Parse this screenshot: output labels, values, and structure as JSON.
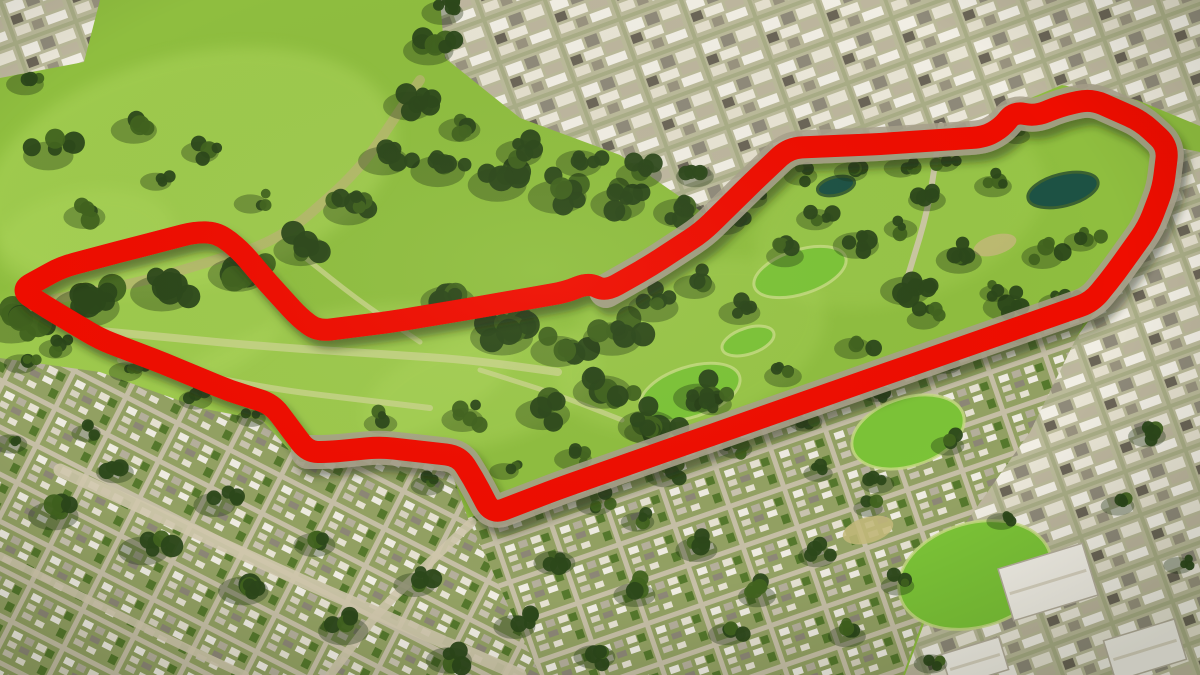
{
  "scene": {
    "title": "Aerial 3D satellite view of a large urban park with a red street-circuit outline",
    "canvas_width": 1200,
    "canvas_height": 675,
    "palette": {
      "grass": "#8fbe3f",
      "grass_light": "#aed75c",
      "grass_bright": "#7cc437",
      "tree": "#2c481a",
      "tree_light": "#41631f",
      "tree_shadow": "#1c3110",
      "path_pale": "#ccd490",
      "creek": "#b8b472",
      "road_light": "#cfc7ac",
      "road": "#a8a18b",
      "water": "#1d5244",
      "building_white": "#f2efe6",
      "building_edge": "#b5ae9c",
      "track_red": "#ef0702",
      "track_shadow": "#1f2a10"
    }
  },
  "track": {
    "name": "street-circuit-outline",
    "stroke_width": 22,
    "corner_radius": 13,
    "closed": true,
    "points": [
      [
        20,
        290
      ],
      [
        62,
        267
      ],
      [
        130,
        249
      ],
      [
        196,
        232
      ],
      [
        218,
        233
      ],
      [
        240,
        250
      ],
      [
        268,
        283
      ],
      [
        300,
        318
      ],
      [
        318,
        331
      ],
      [
        390,
        322
      ],
      [
        468,
        309
      ],
      [
        520,
        300
      ],
      [
        566,
        292
      ],
      [
        588,
        283
      ],
      [
        606,
        291
      ],
      [
        650,
        266
      ],
      [
        702,
        232
      ],
      [
        756,
        179
      ],
      [
        789,
        148
      ],
      [
        880,
        144
      ],
      [
        985,
        137
      ],
      [
        1002,
        127
      ],
      [
        1014,
        112
      ],
      [
        1036,
        116
      ],
      [
        1060,
        106
      ],
      [
        1091,
        99
      ],
      [
        1141,
        121
      ],
      [
        1168,
        146
      ],
      [
        1163,
        188
      ],
      [
        1148,
        227
      ],
      [
        1116,
        272
      ],
      [
        1092,
        302
      ],
      [
        900,
        369
      ],
      [
        700,
        439
      ],
      [
        560,
        488
      ],
      [
        492,
        514
      ],
      [
        473,
        478
      ],
      [
        459,
        456
      ],
      [
        380,
        447
      ],
      [
        330,
        452
      ],
      [
        308,
        452
      ],
      [
        292,
        431
      ],
      [
        272,
        404
      ],
      [
        230,
        391
      ],
      [
        165,
        364
      ],
      [
        100,
        339
      ],
      [
        48,
        308
      ]
    ]
  },
  "road_underlay": {
    "stroke_width": 34,
    "points": [
      [
        606,
        291
      ],
      [
        650,
        266
      ],
      [
        702,
        232
      ],
      [
        756,
        179
      ],
      [
        789,
        148
      ],
      [
        880,
        144
      ],
      [
        985,
        137
      ],
      [
        1002,
        127
      ],
      [
        1014,
        112
      ],
      [
        1036,
        116
      ],
      [
        1060,
        106
      ],
      [
        1091,
        99
      ],
      [
        1141,
        121
      ],
      [
        1168,
        146
      ],
      [
        1163,
        188
      ],
      [
        1148,
        227
      ],
      [
        1116,
        272
      ],
      [
        1092,
        302
      ],
      [
        900,
        369
      ],
      [
        700,
        439
      ],
      [
        560,
        488
      ],
      [
        492,
        514
      ],
      [
        473,
        478
      ],
      [
        459,
        456
      ],
      [
        380,
        447
      ],
      [
        330,
        452
      ],
      [
        308,
        452
      ]
    ]
  },
  "features": {
    "meadows": [
      {
        "x": 190,
        "y": 170,
        "rx": 210,
        "ry": 115,
        "rot": -14,
        "o": 0.5
      },
      {
        "x": 130,
        "y": 330,
        "rx": 160,
        "ry": 70,
        "rot": -10,
        "o": 0.5
      },
      {
        "x": 330,
        "y": 385,
        "rx": 185,
        "ry": 72,
        "rot": -12,
        "o": 0.45
      },
      {
        "x": 480,
        "y": 390,
        "rx": 120,
        "ry": 55,
        "rot": -15,
        "o": 0.4
      },
      {
        "x": 690,
        "y": 345,
        "rx": 140,
        "ry": 80,
        "rot": -18,
        "o": 0.3
      },
      {
        "x": 900,
        "y": 215,
        "rx": 150,
        "ry": 85,
        "rot": -18,
        "o": 0.28
      },
      {
        "x": 85,
        "y": 240,
        "rx": 90,
        "ry": 50,
        "rot": -10,
        "o": 0.4
      }
    ],
    "park_paths": [
      {
        "pts": [
          [
            90,
            330
          ],
          [
            260,
            346
          ],
          [
            470,
            360
          ],
          [
            558,
            372
          ]
        ],
        "w": 8
      },
      {
        "pts": [
          [
            120,
            360
          ],
          [
            280,
            390
          ],
          [
            430,
            408
          ]
        ],
        "w": 6
      },
      {
        "pts": [
          [
            298,
            252
          ],
          [
            358,
            300
          ],
          [
            420,
            342
          ]
        ],
        "w": 5
      },
      {
        "pts": [
          [
            480,
            370
          ],
          [
            556,
            394
          ],
          [
            622,
            420
          ]
        ],
        "w": 5
      },
      {
        "pts": [
          [
            0,
            310
          ],
          [
            150,
            280
          ],
          [
            280,
            240
          ],
          [
            360,
            170
          ],
          [
            420,
            80
          ]
        ],
        "w": 10,
        "c": "creek"
      }
    ],
    "city_regions": [
      {
        "pattern": "city",
        "points": [
          [
            440,
            0
          ],
          [
            1200,
            0
          ],
          [
            1200,
            126
          ],
          [
            1137,
            100
          ],
          [
            1062,
            85
          ],
          [
            1002,
            110
          ],
          [
            986,
            133
          ],
          [
            792,
            141
          ],
          [
            706,
            215
          ],
          [
            620,
            155
          ],
          [
            520,
            118
          ],
          [
            445,
            58
          ]
        ]
      },
      {
        "pattern": "city",
        "points": [
          [
            0,
            0
          ],
          [
            100,
            0
          ],
          [
            84,
            62
          ],
          [
            0,
            78
          ]
        ]
      },
      {
        "pattern": "city",
        "points": [
          [
            1180,
            148
          ],
          [
            1200,
            152
          ],
          [
            1200,
            675
          ],
          [
            905,
            675
          ],
          [
            955,
            540
          ],
          [
            1005,
            432
          ],
          [
            1060,
            360
          ],
          [
            1098,
            308
          ],
          [
            1135,
            242
          ],
          [
            1158,
            206
          ]
        ]
      },
      {
        "pattern": "resid1",
        "points": [
          [
            0,
            358
          ],
          [
            100,
            372
          ],
          [
            200,
            408
          ],
          [
            262,
            420
          ],
          [
            300,
            462
          ],
          [
            444,
            452
          ],
          [
            468,
            518
          ],
          [
            540,
            675
          ],
          [
            0,
            675
          ]
        ]
      },
      {
        "pattern": "resid2",
        "points": [
          [
            468,
            518
          ],
          [
            1092,
            306
          ],
          [
            1030,
            432
          ],
          [
            950,
            545
          ],
          [
            903,
            675
          ],
          [
            540,
            675
          ]
        ]
      }
    ],
    "sports_fields": [
      {
        "x": 800,
        "y": 272,
        "rx": 48,
        "ry": 22,
        "rot": -18
      },
      {
        "x": 690,
        "y": 392,
        "rx": 52,
        "ry": 25,
        "rot": -18
      },
      {
        "x": 908,
        "y": 432,
        "rx": 58,
        "ry": 34,
        "rot": -18
      },
      {
        "x": 748,
        "y": 341,
        "rx": 27,
        "ry": 13,
        "rot": -18
      },
      {
        "x": 975,
        "y": 575,
        "rx": 78,
        "ry": 52,
        "rot": -16
      }
    ],
    "dirt_patches": [
      {
        "x": 868,
        "y": 530,
        "rx": 26,
        "ry": 13,
        "rot": -16
      },
      {
        "x": 995,
        "y": 245,
        "rx": 22,
        "ry": 10,
        "rot": -16
      }
    ],
    "ponds": [
      {
        "x": 1063,
        "y": 190,
        "rx": 36,
        "ry": 16,
        "rot": -14
      },
      {
        "x": 836,
        "y": 186,
        "rx": 19,
        "ry": 9,
        "rot": -14
      }
    ],
    "roads": [
      {
        "pts": [
          [
            941,
            125
          ],
          [
            928,
            210
          ],
          [
            903,
            292
          ]
        ],
        "w": 6
      },
      {
        "pts": [
          [
            60,
            470
          ],
          [
            300,
            580
          ],
          [
            520,
            675
          ]
        ],
        "w": 13
      },
      {
        "pts": [
          [
            0,
            556
          ],
          [
            180,
            645
          ],
          [
            245,
            675
          ]
        ],
        "w": 8
      },
      {
        "pts": [
          [
            472,
            522
          ],
          [
            430,
            562
          ],
          [
            378,
            612
          ],
          [
            330,
            675
          ]
        ],
        "w": 9
      }
    ],
    "big_buildings": [
      {
        "x": 1048,
        "y": 582,
        "w": 88,
        "h": 54,
        "rot": -17
      },
      {
        "x": 1145,
        "y": 650,
        "w": 74,
        "h": 42,
        "rot": -17
      },
      {
        "x": 975,
        "y": 662,
        "w": 60,
        "h": 34,
        "rot": -17
      }
    ],
    "tree_clusters": [
      [
        20,
        318,
        30,
        8
      ],
      [
        95,
        300,
        32,
        9
      ],
      [
        170,
        286,
        30,
        8
      ],
      [
        245,
        268,
        28,
        8
      ],
      [
        308,
        244,
        26,
        7
      ],
      [
        355,
        205,
        24,
        7
      ],
      [
        390,
        155,
        24,
        7
      ],
      [
        415,
        100,
        24,
        7
      ],
      [
        435,
        45,
        24,
        7
      ],
      [
        448,
        8,
        20,
        5
      ],
      [
        55,
        150,
        24,
        5
      ],
      [
        140,
        125,
        22,
        4
      ],
      [
        90,
        212,
        20,
        4
      ],
      [
        205,
        148,
        18,
        4
      ],
      [
        30,
        80,
        18,
        4
      ],
      [
        255,
        200,
        16,
        3
      ],
      [
        160,
        178,
        15,
        3
      ],
      [
        445,
        165,
        26,
        7
      ],
      [
        505,
        178,
        28,
        8
      ],
      [
        565,
        190,
        28,
        8
      ],
      [
        625,
        198,
        26,
        7
      ],
      [
        685,
        207,
        24,
        6
      ],
      [
        730,
        218,
        20,
        5
      ],
      [
        465,
        125,
        20,
        5
      ],
      [
        525,
        148,
        22,
        5
      ],
      [
        585,
        158,
        22,
        5
      ],
      [
        645,
        170,
        22,
        5
      ],
      [
        700,
        172,
        18,
        4
      ],
      [
        755,
        195,
        16,
        4
      ],
      [
        455,
        295,
        26,
        7
      ],
      [
        510,
        330,
        30,
        8
      ],
      [
        565,
        345,
        26,
        7
      ],
      [
        620,
        332,
        28,
        7
      ],
      [
        660,
        302,
        24,
        6
      ],
      [
        610,
        385,
        28,
        7
      ],
      [
        550,
        408,
        26,
        6
      ],
      [
        655,
        420,
        28,
        7
      ],
      [
        705,
        392,
        24,
        6
      ],
      [
        745,
        308,
        20,
        5
      ],
      [
        700,
        282,
        20,
        5
      ],
      [
        790,
        252,
        18,
        4
      ],
      [
        820,
        215,
        18,
        4
      ],
      [
        805,
        172,
        16,
        4
      ],
      [
        855,
        168,
        16,
        4
      ],
      [
        905,
        164,
        16,
        4
      ],
      [
        948,
        160,
        14,
        3
      ],
      [
        1020,
        133,
        13,
        3
      ],
      [
        862,
        240,
        22,
        5
      ],
      [
        912,
        285,
        24,
        6
      ],
      [
        965,
        255,
        22,
        5
      ],
      [
        1012,
        302,
        22,
        5
      ],
      [
        1048,
        252,
        20,
        4
      ],
      [
        998,
        182,
        18,
        4
      ],
      [
        932,
        196,
        18,
        4
      ],
      [
        1085,
        238,
        16,
        4
      ],
      [
        1062,
        300,
        18,
        4
      ],
      [
        905,
        225,
        16,
        3
      ],
      [
        578,
        455,
        18,
        4
      ],
      [
        648,
        428,
        18,
        4
      ],
      [
        718,
        400,
        18,
        4
      ],
      [
        788,
        372,
        18,
        4
      ],
      [
        858,
        344,
        18,
        4
      ],
      [
        928,
        316,
        16,
        4
      ],
      [
        998,
        290,
        14,
        3
      ],
      [
        600,
        500,
        18,
        4
      ],
      [
        670,
        472,
        18,
        4
      ],
      [
        740,
        445,
        16,
        4
      ],
      [
        810,
        418,
        16,
        4
      ],
      [
        880,
        390,
        14,
        3
      ],
      [
        950,
        362,
        14,
        3
      ],
      [
        1020,
        335,
        12,
        3
      ],
      [
        468,
        415,
        20,
        5
      ],
      [
        432,
        482,
        16,
        4
      ],
      [
        508,
        468,
        14,
        3
      ],
      [
        385,
        420,
        16,
        3
      ],
      [
        60,
        345,
        16,
        4
      ],
      [
        130,
        368,
        16,
        4
      ],
      [
        200,
        396,
        16,
        4
      ],
      [
        255,
        415,
        14,
        3
      ],
      [
        60,
        510,
        24,
        5
      ],
      [
        150,
        545,
        24,
        5
      ],
      [
        250,
        585,
        24,
        5
      ],
      [
        350,
        625,
        24,
        5
      ],
      [
        455,
        655,
        22,
        4
      ],
      [
        120,
        468,
        18,
        4
      ],
      [
        220,
        500,
        20,
        4
      ],
      [
        320,
        540,
        20,
        4
      ],
      [
        420,
        580,
        20,
        4
      ],
      [
        520,
        622,
        20,
        4
      ],
      [
        600,
        652,
        20,
        4
      ],
      [
        560,
        558,
        20,
        4
      ],
      [
        640,
        590,
        20,
        4
      ],
      [
        702,
        545,
        20,
        4
      ],
      [
        762,
        592,
        18,
        4
      ],
      [
        822,
        552,
        18,
        4
      ],
      [
        642,
        518,
        16,
        3
      ],
      [
        732,
        630,
        18,
        4
      ],
      [
        852,
        632,
        18,
        4
      ],
      [
        902,
        582,
        16,
        3
      ],
      [
        882,
        480,
        16,
        3
      ],
      [
        952,
        442,
        16,
        3
      ],
      [
        822,
        470,
        14,
        3
      ],
      [
        25,
        360,
        16,
        4
      ],
      [
        15,
        440,
        16,
        3
      ],
      [
        90,
        430,
        14,
        3
      ],
      [
        1152,
        432,
        18,
        4
      ],
      [
        1122,
        502,
        16,
        3
      ],
      [
        1182,
        562,
        14,
        3
      ],
      [
        935,
        660,
        16,
        3
      ],
      [
        1005,
        518,
        14,
        3
      ],
      [
        872,
        505,
        14,
        3
      ]
    ]
  }
}
